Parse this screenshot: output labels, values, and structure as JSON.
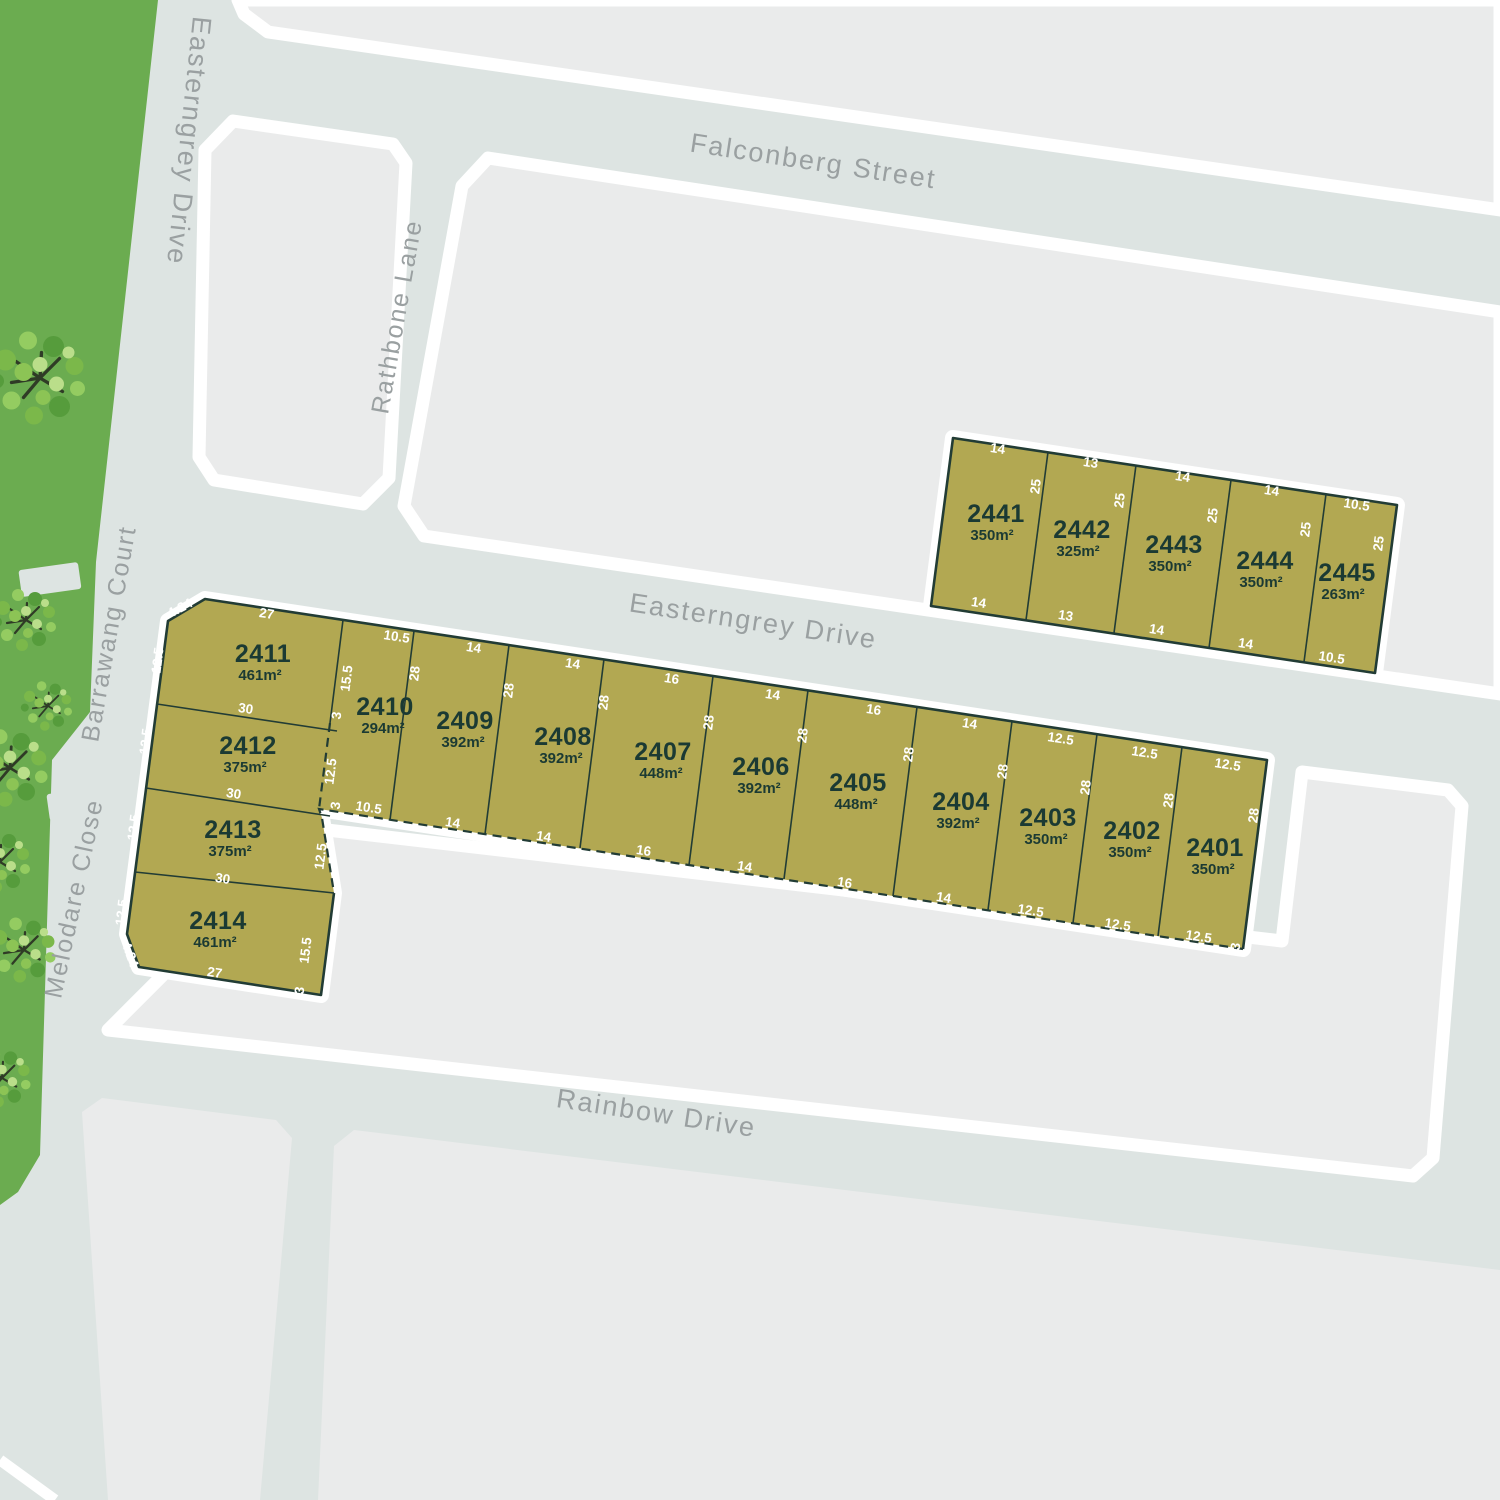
{
  "streets": {
    "easterngrey_top": "Easterngrey Drive",
    "falconberg": "Falconberg Street",
    "rathbone": "Rathbone Lane",
    "easterngrey_mid": "Easterngrey Drive",
    "barrawang": "Barrawang Court",
    "melodare": "Melodare Close",
    "rainbow": "Rainbow Drive"
  },
  "row_lots": [
    {
      "id": "2410",
      "area": "294m²",
      "front": "10.5",
      "rear": "10.5",
      "side": "28"
    },
    {
      "id": "2409",
      "area": "392m²",
      "front": "14",
      "rear": "14",
      "side": "28"
    },
    {
      "id": "2408",
      "area": "392m²",
      "front": "14",
      "rear": "14",
      "side": "28"
    },
    {
      "id": "2407",
      "area": "448m²",
      "front": "16",
      "rear": "16",
      "side": "28"
    },
    {
      "id": "2406",
      "area": "392m²",
      "front": "14",
      "rear": "14",
      "side": "28"
    },
    {
      "id": "2405",
      "area": "448m²",
      "front": "16",
      "rear": "16",
      "side": "28"
    },
    {
      "id": "2404",
      "area": "392m²",
      "front": "14",
      "rear": "14",
      "side": "28"
    },
    {
      "id": "2403",
      "area": "350m²",
      "front": "12.5",
      "rear": "12.5",
      "side": "28"
    },
    {
      "id": "2402",
      "area": "350m²",
      "front": "12.5",
      "rear": "12.5",
      "side": "28"
    },
    {
      "id": "2401",
      "area": "350m²",
      "front": "12.5",
      "rear": "12.5",
      "side": "28"
    }
  ],
  "column_lots": [
    {
      "id": "2411",
      "area": "461m²",
      "west": "12.5"
    },
    {
      "id": "2412",
      "area": "375m²",
      "west": "12.5"
    },
    {
      "id": "2413",
      "area": "375m²",
      "west": "12.5"
    },
    {
      "id": "2414",
      "area": "461m²",
      "west": "12.5"
    }
  ],
  "north_lots": [
    {
      "id": "2441",
      "area": "350m²",
      "front": "14",
      "rear": "14",
      "side": "25"
    },
    {
      "id": "2442",
      "area": "325m²",
      "front": "13",
      "rear": "13",
      "side": "25"
    },
    {
      "id": "2443",
      "area": "350m²",
      "front": "14",
      "rear": "14",
      "side": "25"
    },
    {
      "id": "2444",
      "area": "350m²",
      "front": "14",
      "rear": "14",
      "side": "25"
    },
    {
      "id": "2445",
      "area": "263m²",
      "front": "10.5",
      "rear": "10.5",
      "side": "25"
    }
  ],
  "boundary_dims": {
    "lot2411_front": "27",
    "lot2411_2412": "30",
    "lot2412_2413": "30",
    "lot2413_2414": "30",
    "lot2414_south": "27",
    "lot2411_chamfer": "4.24",
    "lot2414_chamfer": "4.24",
    "junction_155": "15.5",
    "junction_3a": "3",
    "junction_125": "12.5",
    "junction_3b": "3",
    "column_east_125": "12.5",
    "column_east_155": "15.5",
    "column_east_3": "3",
    "row_se_3": "3"
  },
  "colors": {
    "road": "#dde4e2",
    "block": "#eaebeb",
    "green_space": "#6bac50",
    "lot_fill": "#b2a852",
    "lot_outline": "#223c35",
    "lot_text": "#1b3a33",
    "dim_text": "#ffffff",
    "street_text": "#9aa0a1",
    "road_border": "#ffffff"
  }
}
